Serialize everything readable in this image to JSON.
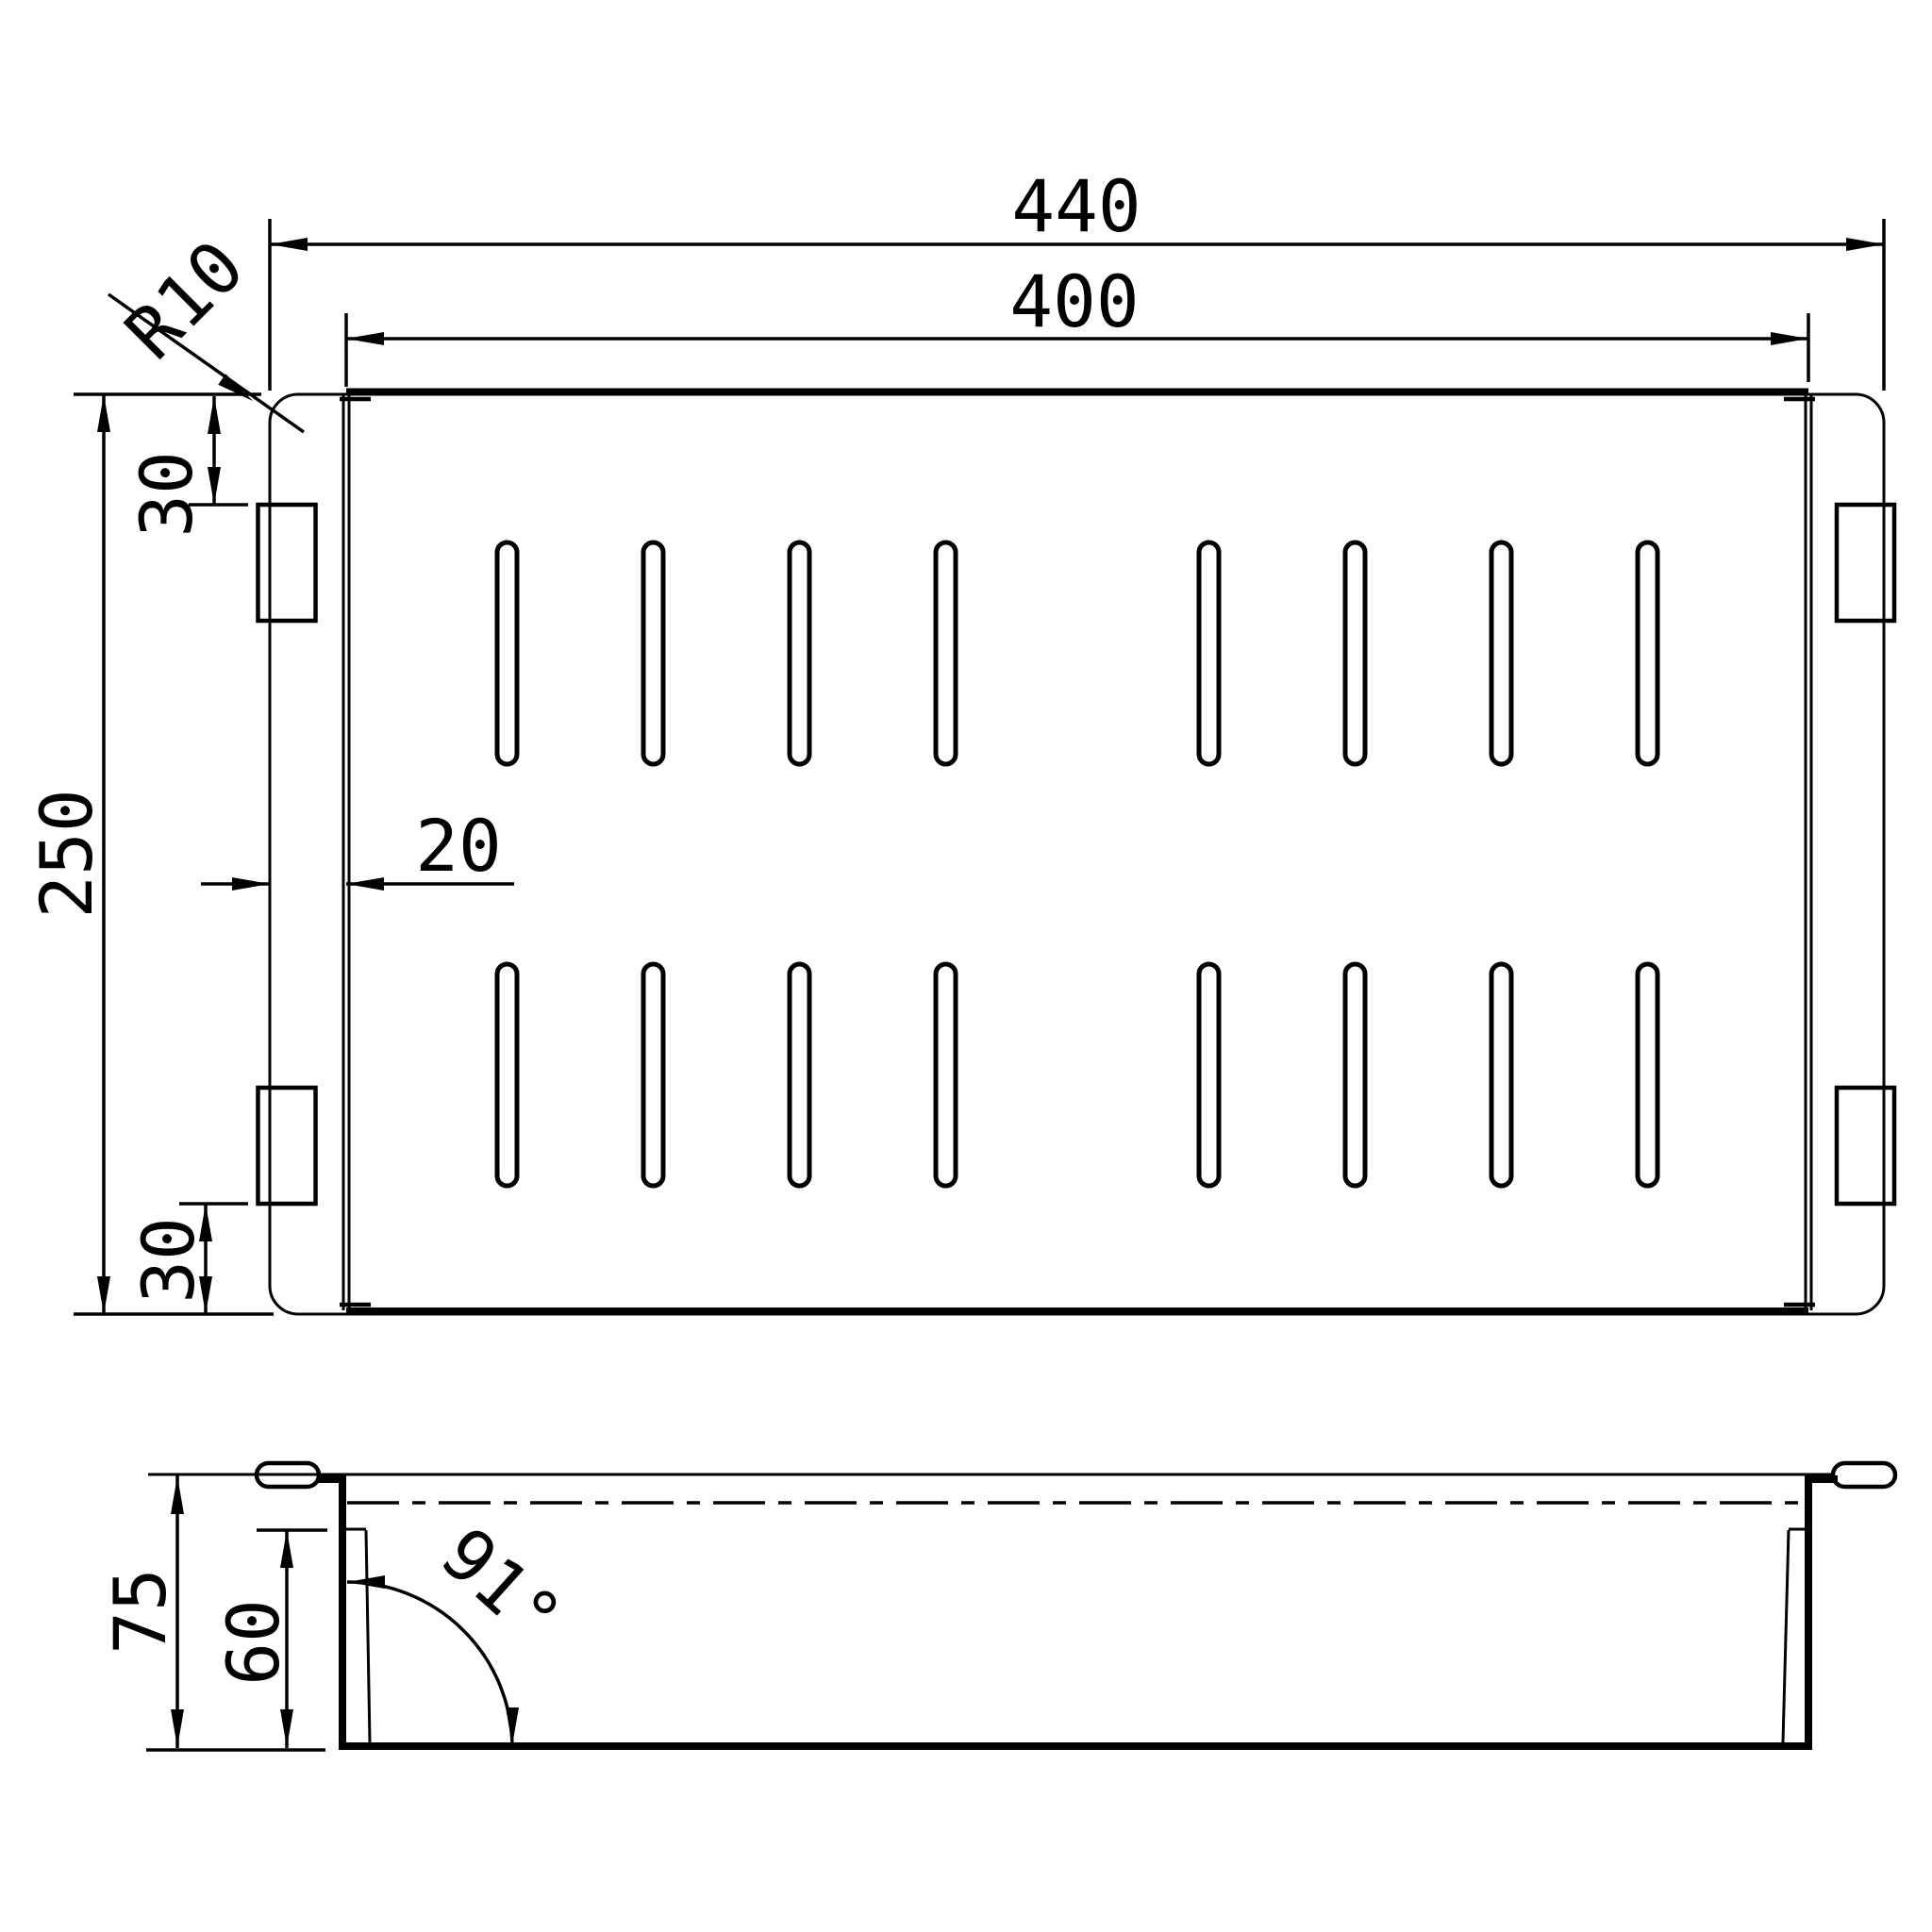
{
  "drawing": {
    "description": "CAD technical drawing of a perforated rectangular colander tray, top view and side section view",
    "colors": {
      "line": "#000000",
      "background": "#ffffff"
    },
    "views": {
      "top_view": {
        "name": "top-view",
        "dimensions": {
          "overall_width": {
            "label": "440"
          },
          "inner_width": {
            "label": "400"
          },
          "overall_depth": {
            "label": "250"
          },
          "corner_radius": {
            "label": "R10"
          },
          "tab_offset_top": {
            "label": "30"
          },
          "tab_offset_bottom": {
            "label": "30"
          },
          "flange_width": {
            "label": "20"
          }
        },
        "features": {
          "slot_rows": 2,
          "slots_per_row": 8,
          "side_tabs": 4
        }
      },
      "side_view": {
        "name": "side-section-view",
        "dimensions": {
          "total_height": {
            "label": "75"
          },
          "inner_depth": {
            "label": "60"
          },
          "wall_angle": {
            "label": "91°"
          }
        }
      }
    }
  }
}
